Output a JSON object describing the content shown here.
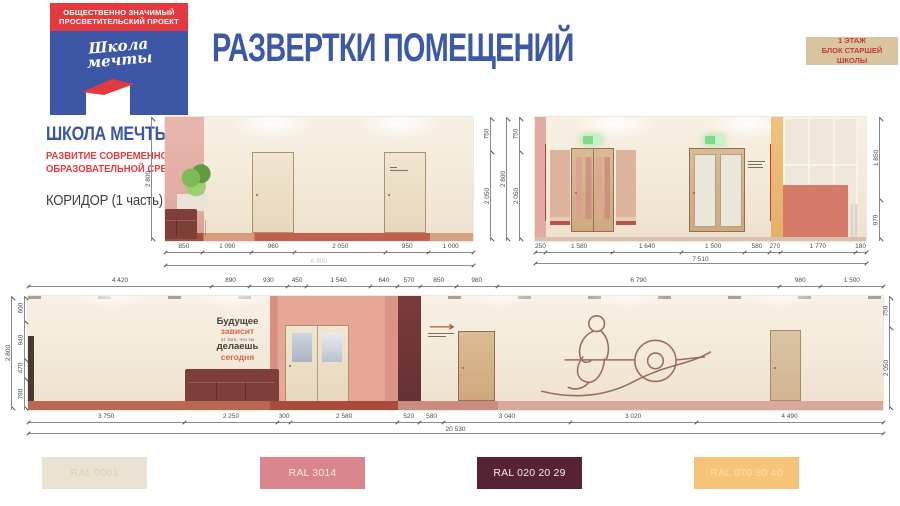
{
  "logo": {
    "banner1": "ОБЩЕСТВЕННО ЗНАЧИМЫЙ",
    "banner2": "ПРОСВЕТИТЕЛЬСКИЙ ПРОЕКТ",
    "script1": "Школа",
    "script2": "мечты"
  },
  "sidebar": {
    "brand": "ШКОЛА МЕЧТЫ",
    "sub1": "РАЗВИТИЕ СОВРЕМЕННОЙ",
    "sub2": "ОБРАЗОВАТЕЛЬНОЙ СРЕДЫ",
    "room": "КОРИДОР (1 часть)"
  },
  "header": {
    "title": "РАЗВЕРТКИ ПОМЕЩЕНИЙ",
    "badge1": "1 ЭТАЖ",
    "badge2": "БЛОК СТАРШЕЙ ШКОЛЫ"
  },
  "e1": {
    "left_total": "2 800",
    "right": [
      "750",
      "2 050"
    ],
    "bottom": [
      "850",
      "1 090",
      "960",
      "2 050",
      "950",
      "1 000"
    ],
    "total": "6 900"
  },
  "e2": {
    "left_total": "2 800",
    "left": [
      "750",
      "2 050"
    ],
    "right": [
      "1 850",
      "970"
    ],
    "bottom": [
      "250",
      "1 580",
      "1 640",
      "1 500",
      "580",
      "270",
      "1 770",
      "180"
    ],
    "total": "7 510"
  },
  "e3": {
    "top": [
      "4 420",
      "890",
      "930",
      "450",
      "1 540",
      "640",
      "570",
      "850",
      "980",
      "6 790",
      "980",
      "1 500"
    ],
    "left_total": "2 800",
    "left": [
      "600",
      "940",
      "470",
      "790"
    ],
    "right": [
      "750",
      "2 050"
    ],
    "bottom": [
      "3 750",
      "2 250",
      "300",
      "2 580",
      "520",
      "580",
      "3 040",
      "3 020",
      "4 490"
    ],
    "total": "20 530",
    "wall_text": [
      "Будущее",
      "зависит",
      "от того, что ты",
      "делаешь",
      "сегодня"
    ]
  },
  "swatches": [
    {
      "label": "RAL 9001",
      "bg": "#EAE3D1",
      "fg": "#DCD2B5"
    },
    {
      "label": "RAL 3014",
      "bg": "#D8858B",
      "fg": "#F3E6E4"
    },
    {
      "label": "RAL 020 20 29",
      "bg": "#582235",
      "fg": "#F2ECEC"
    },
    {
      "label": "RAL 070 80 40",
      "bg": "#F5C478",
      "fg": "#FADFA8"
    }
  ],
  "colors": {
    "accent_blue": "#3C59A6",
    "accent_red": "#E23A3E",
    "badge_bg": "#D8C5A0",
    "badge_fg": "#C23B33"
  }
}
